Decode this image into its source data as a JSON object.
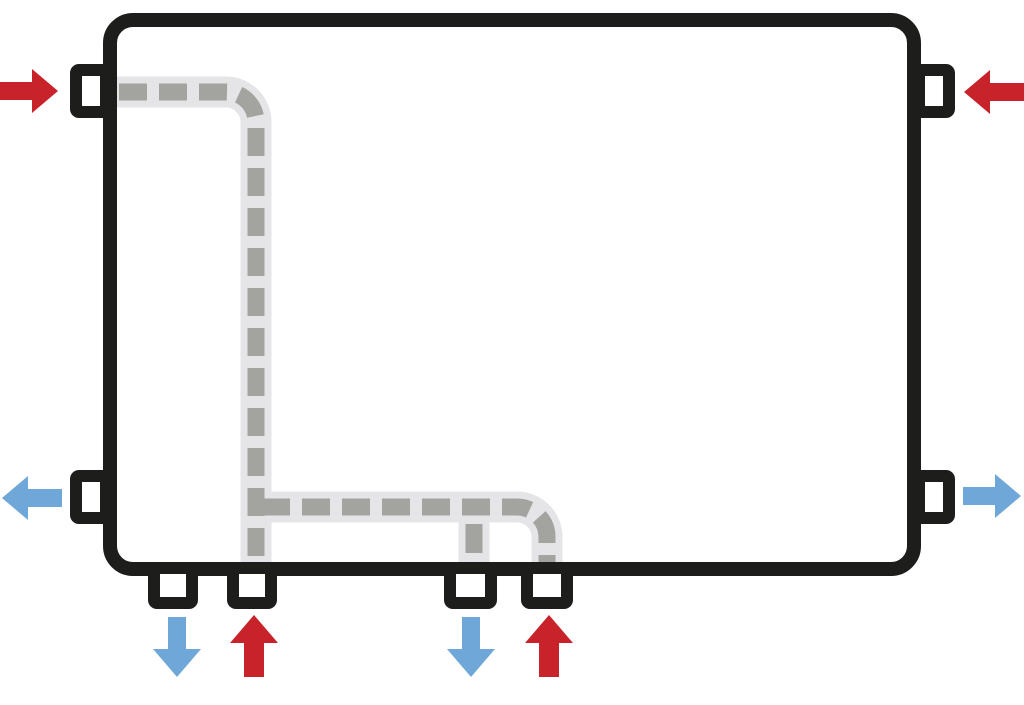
{
  "diagram": {
    "name": "radiator-connection-diagram",
    "type": "piping-schematic",
    "description": "Panel radiator outline with eight connection ports, internal dashed pipe route, red supply (flow in) arrows and blue return (flow out) arrows. No visible text in the image.",
    "colors": {
      "outline": "#1d1d1b",
      "supply": "#c8232a",
      "return": "#6ea7d8",
      "pipe_tube": "#e5e5e8",
      "pipe_dash": "#a3a3a0",
      "background": "#ffffff"
    },
    "body": {
      "shape": "rounded-rectangle",
      "border_style": "thick-black-outline"
    },
    "ports": [
      {
        "id": "port-left-top",
        "position": "left-side-top",
        "flow": "supply-in"
      },
      {
        "id": "port-left-bottom",
        "position": "left-side-bottom",
        "flow": "return-out"
      },
      {
        "id": "port-right-top",
        "position": "right-side-top",
        "flow": "supply-in"
      },
      {
        "id": "port-right-bottom",
        "position": "right-side-bottom",
        "flow": "return-out"
      },
      {
        "id": "port-bottom-1",
        "position": "bottom-left-outer",
        "flow": "return-out"
      },
      {
        "id": "port-bottom-2",
        "position": "bottom-left-inner",
        "flow": "supply-in"
      },
      {
        "id": "port-bottom-3",
        "position": "bottom-mid-outer",
        "flow": "return-out"
      },
      {
        "id": "port-bottom-4",
        "position": "bottom-mid-inner",
        "flow": "supply-in"
      }
    ],
    "arrows": [
      {
        "id": "supply-arrow-left-top",
        "direction": "right",
        "color_role": "supply"
      },
      {
        "id": "supply-arrow-right-top",
        "direction": "left",
        "color_role": "supply"
      },
      {
        "id": "return-arrow-left-bottom",
        "direction": "left",
        "color_role": "return"
      },
      {
        "id": "return-arrow-right-bottom",
        "direction": "right",
        "color_role": "return"
      },
      {
        "id": "return-arrow-bottom-1",
        "direction": "down",
        "color_role": "return"
      },
      {
        "id": "supply-arrow-bottom-2",
        "direction": "up",
        "color_role": "supply"
      },
      {
        "id": "return-arrow-bottom-3",
        "direction": "down",
        "color_role": "return"
      },
      {
        "id": "supply-arrow-bottom-4",
        "direction": "up",
        "color_role": "supply"
      }
    ],
    "pipe": {
      "style": "light-grey tube with dark-grey dashes",
      "route": "from left-top port horizontally, elbow down, vertical run to bottom-left-inner port; branch near bottom runs right with a tee drop to bottom-mid-outer port and an elbow down into bottom-mid-inner port"
    }
  }
}
